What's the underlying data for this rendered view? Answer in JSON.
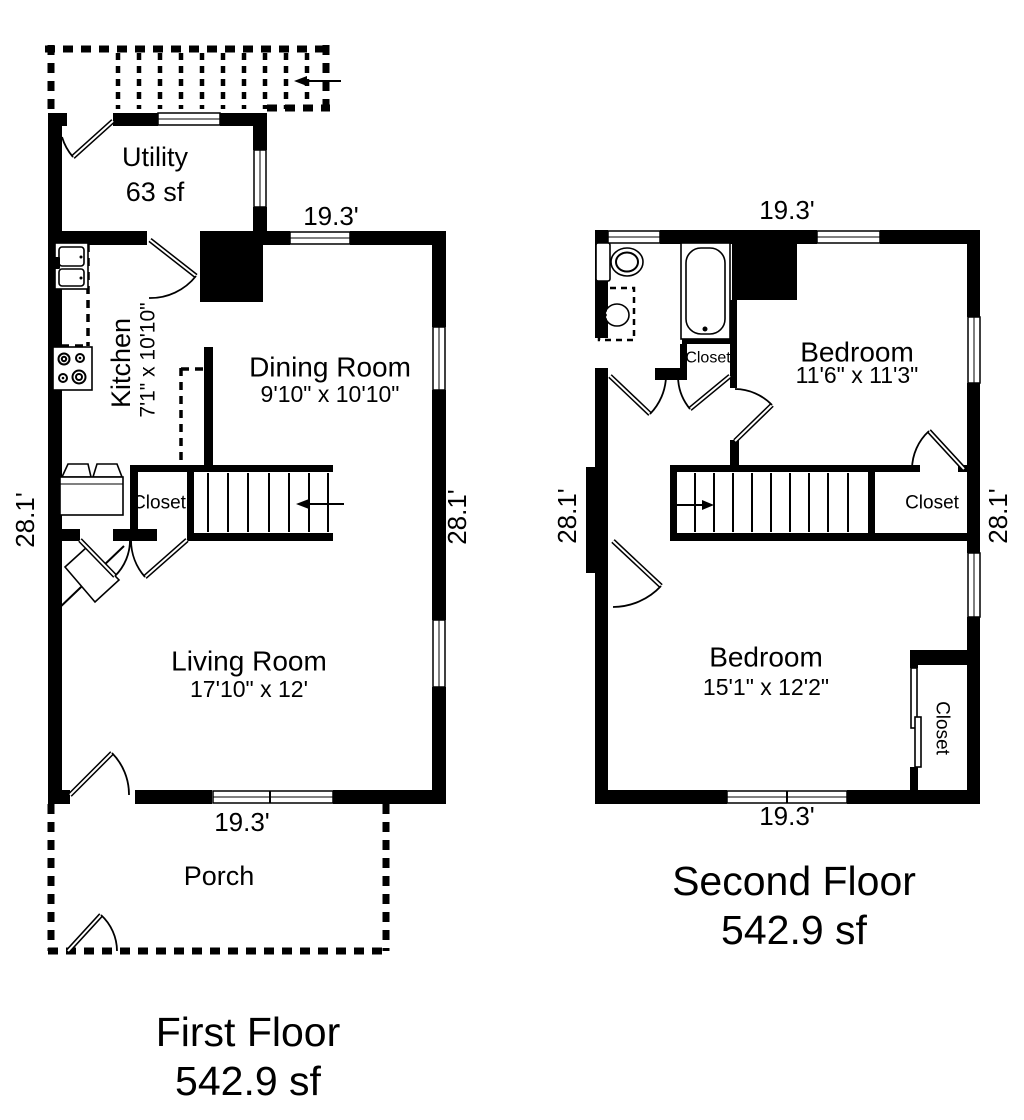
{
  "colors": {
    "wall": "#000000",
    "background": "#ffffff",
    "text": "#000000"
  },
  "first_floor": {
    "title": "First Floor",
    "area": "542.9 sf",
    "dims": {
      "top": "19.3'",
      "bottom": "19.3'",
      "left": "28.1'",
      "right": "28.1'"
    },
    "rooms": {
      "utility": {
        "name": "Utility",
        "area": "63 sf"
      },
      "kitchen": {
        "name": "Kitchen",
        "size": "7'1\" x 10'10\""
      },
      "dining": {
        "name": "Dining Room",
        "size": "9'10\" x 10'10\""
      },
      "living": {
        "name": "Living Room",
        "size": "17'10\" x 12'"
      },
      "closet": {
        "name": "Closet"
      },
      "porch": {
        "name": "Porch"
      }
    }
  },
  "second_floor": {
    "title": "Second Floor",
    "area": "542.9 sf",
    "dims": {
      "top": "19.3'",
      "bottom": "19.3'",
      "left": "28.1'",
      "right": "28.1'"
    },
    "rooms": {
      "bedroom1": {
        "name": "Bedroom",
        "size": "11'6\" x 11'3\""
      },
      "bedroom2": {
        "name": "Bedroom",
        "size": "15'1\" x 12'2\""
      },
      "bath_closet": {
        "name": "Closet"
      },
      "stair_closet": {
        "name": "Closet"
      },
      "bedroom_closet": {
        "name": "Closet"
      }
    }
  }
}
